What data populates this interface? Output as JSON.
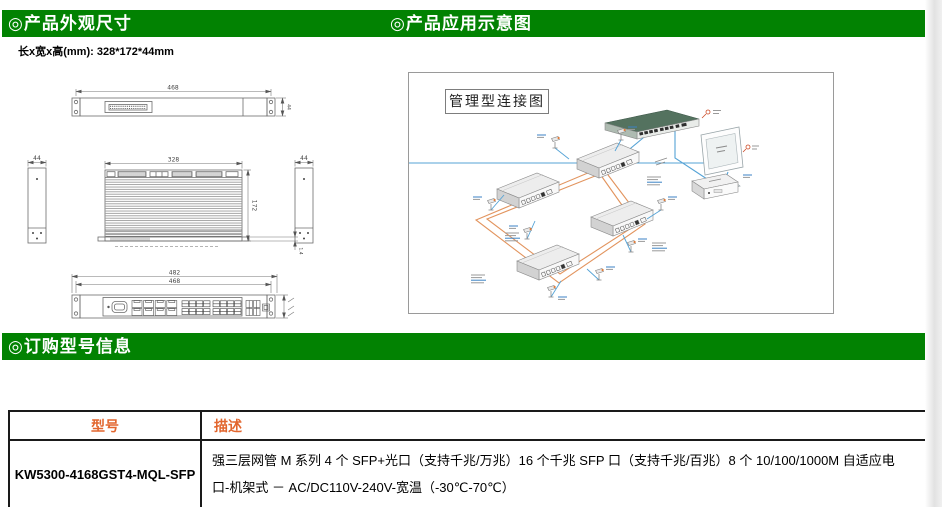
{
  "page": {
    "accent_green": "#028202",
    "table_header_color": "#e2662e"
  },
  "header": {
    "left_title": "◎产品外观尺寸",
    "right_title": "◎产品应用示意图"
  },
  "dimensions_section": {
    "size_label": "长x宽x高(mm): 328*172*44mm",
    "drawing": {
      "rear_width": "468",
      "rear_height": "44",
      "side_left": "44",
      "side_right": "44",
      "top_width": "328",
      "top_depth": "172",
      "base": "1.4",
      "front_outer": "482",
      "front_inner": "468"
    }
  },
  "application_section": {
    "diagram_title": "管理型连接图"
  },
  "ordering_section": {
    "title": "◎订购型号信息"
  },
  "order_table": {
    "col_model": "型号",
    "col_desc": "描述",
    "rows": [
      {
        "model": "KW5300-4168GST4-MQL-SFP",
        "desc_line1": "强三层网管 M 系列 4 个 SFP+光口（支持千兆/万兆）16 个千兆 SFP 口（支持千兆/百兆）8 个 10/100/1000M 自适应电",
        "desc_line2": "口-机架式 － AC/DC110V-240V-宽温（-30℃-70℃）"
      }
    ]
  }
}
